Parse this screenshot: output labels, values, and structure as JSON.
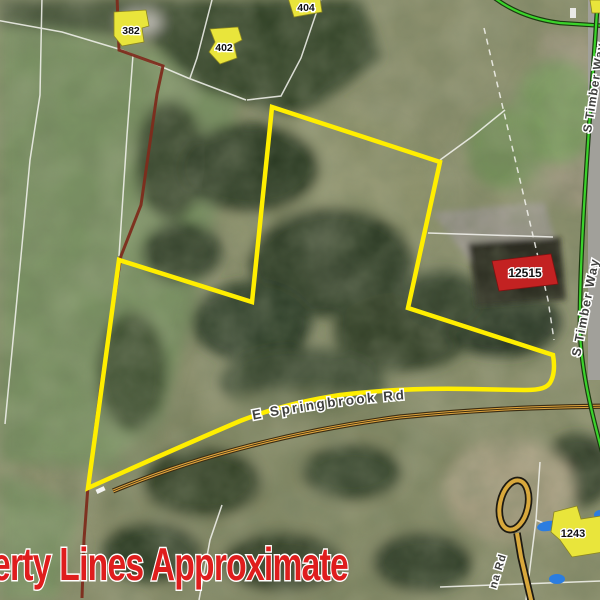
{
  "map_view": {
    "caption": "erty Lines Approximate",
    "road_labels": {
      "e_springbrook_rd": "E Springbrook Rd",
      "s_timber_way_north": "S Timber Way",
      "s_timber_way_south": "S Timber Way",
      "partial_road_bottom": "na Rd"
    },
    "address_labels": {
      "lot_382": "382",
      "lot_402": "402",
      "lot_404": "404",
      "lot_12515": "12515",
      "lot_1243": "1243"
    },
    "colors": {
      "subject_parcel_yellow": "#ffee00",
      "property_line_red": "#7d2c1c",
      "route_green": "#3bd32b",
      "road_centerline_orange": "#dfa43d",
      "address_footprint_yellow": "#e9e53b",
      "address_footprint_red": "#c32222",
      "caption_red": "#df1d1d",
      "water_blue": "#2b7de0",
      "parcel_line_white": "#f5f5f0"
    }
  }
}
